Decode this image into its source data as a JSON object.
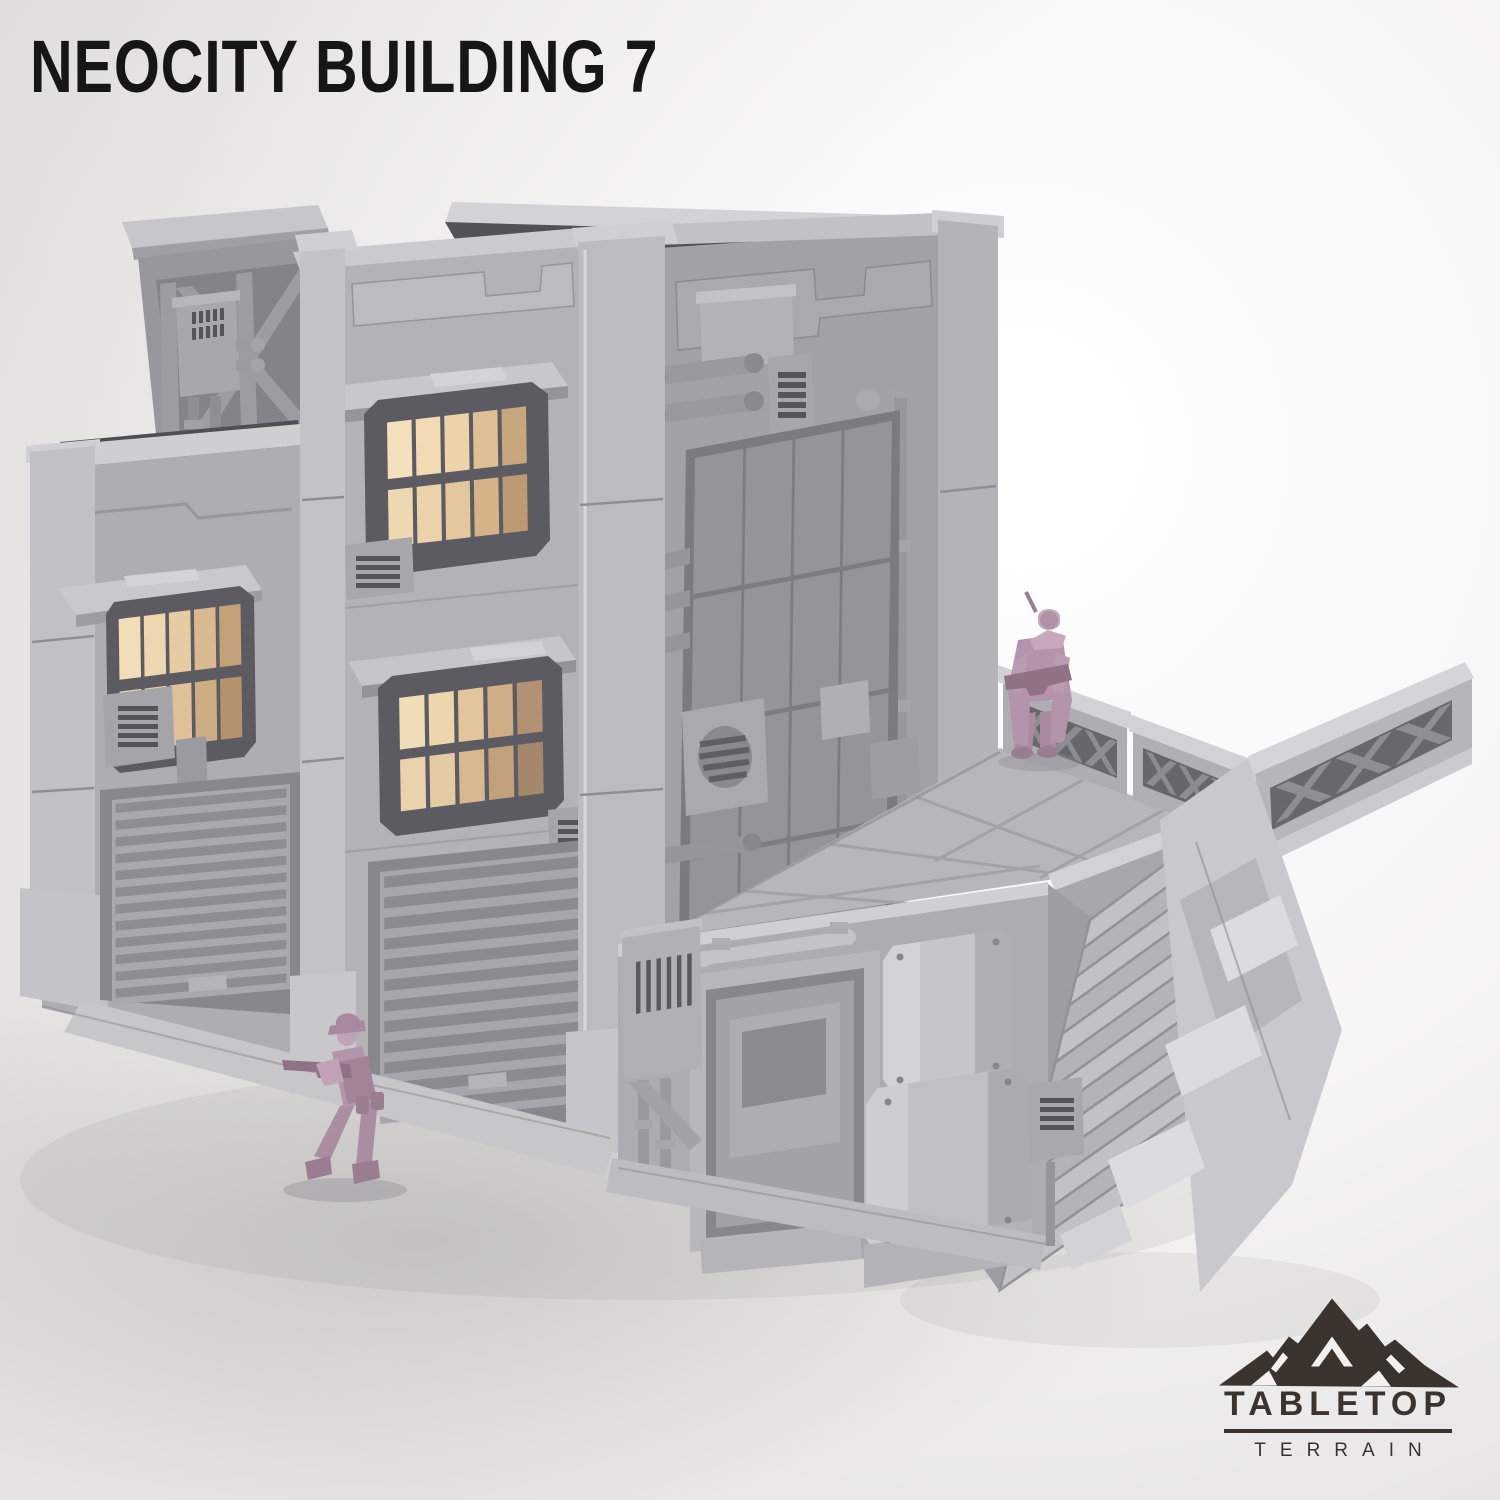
{
  "header": {
    "title": "NEOCITY BUILDING 7"
  },
  "brand": {
    "name": "TABLETOP",
    "subname": "TERRAIN"
  },
  "scene": {
    "product": "grey sci-fi tabletop terrain building render",
    "figures_count": 2,
    "objects": [
      "tilted-rooftop-container",
      "main-tower",
      "left-block",
      "right-face-tile-panel",
      "lit-windows-with-awnings",
      "garage-door-left",
      "garage-door-main",
      "entrance-door",
      "utility-boxes-and-pipes",
      "rooftop-platform",
      "x-lattice-railings",
      "grand-staircase",
      "hex-support-column",
      "miniature-soldier-on-platform",
      "miniature-soldier-on-ground"
    ],
    "colors": {
      "background": "#f4f3f3",
      "ground_shade": "#c9c7c6",
      "building_light": "#c6c5ca",
      "building_mid": "#b3b2b7",
      "building_dark": "#a2a1a7",
      "recess_dark": "#55545a",
      "window_glow": "#f2dcb6",
      "window_glow_dim": "#cfae87",
      "figure_mauve": "#b494aa",
      "logo_charcoal": "#3b332d",
      "title_black": "#161616"
    }
  }
}
